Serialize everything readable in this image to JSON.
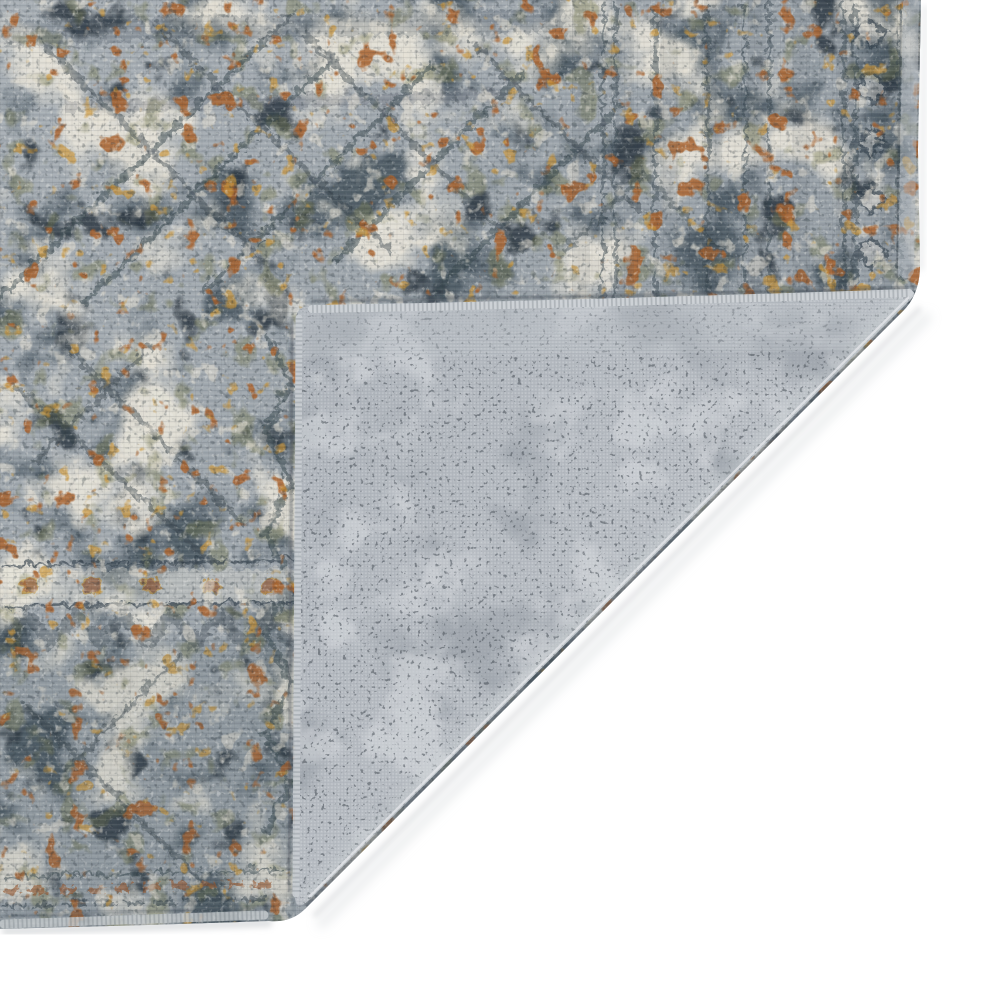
{
  "scene": {
    "type": "product-photo",
    "subject": "area-rug corner folded back to reveal woven backing",
    "rug_style": "distressed vintage oriental pattern in slate blue, gray, ivory with rust and gold accents",
    "backing_style": "fine gray machine-woven grid backing",
    "background": "plain white seamless backdrop",
    "visible_text": ""
  },
  "palette": {
    "white": "#ffffff",
    "pile_light": "#a9b0b6",
    "pile_base": "#8d969e",
    "cream": "#e9e5da",
    "cream2": "#e7e2d6",
    "dark_slate": "#46545f",
    "deep_ink": "#2c363f",
    "rust": "#a9622d",
    "gold": "#c9953a",
    "olive": "#72744c",
    "motif_dark": "#36434d",
    "rosette_fill": "#96542c",
    "rosette_ring": "#c9953a",
    "rust_band": "#a0592a",
    "grain_dark": "#273139",
    "grain_light": "#f2f2ef",
    "weave_base": "#b6bbc1",
    "weave_line": "#9aa0a8",
    "weave_dot": "#dde0e3",
    "backing_mid": "#aeb4bb",
    "backing_light_grad": "#cbcfd4",
    "backing_mottle_dark": "#949ba3",
    "backing_mottle_light": "#d7dade",
    "backing_speck": "#3e454d",
    "backing_ridge": "#c4c9ce",
    "serge_light": "#cfd3d7",
    "serge_left": "#c9cdd1",
    "bottom_serge": "#c6cacd",
    "right_binding": "#b6bcc2",
    "crease_highlight_col": "#e3e5e8",
    "crease_soft_col": "#ced3d8",
    "shadow_soft": "#cdd0d3",
    "shadow_tint": "#c7cacd",
    "junction_shadow": "#39424b",
    "crease_dark": "#4a525a"
  },
  "geometry": {
    "viewbox": "0 0 1000 1000",
    "rug_outline": "M0,0 L921,0 L918,150 L920,268 Q919,296 902,312 L305,909 Q291,923 269,921 L148,925 L0,929 Z",
    "flap_outline": "M912,291 Q917,293 911,299 L310,899 Q296,913 295,897 L296,320 Q296,307 309,306 Q480,303 700,297 Q820,294 912,291 Z",
    "backing_ridge_zone": "M297,304 L911,291 L905,350 L299,358 Z",
    "crease_edge_dark": "M905,309 L306,906",
    "crease_highlight": "M909,297 L309,897",
    "crease_soft_light": "M906,300 L307,900",
    "shadow_crease_outer": "M919,309 L315,915",
    "shadow_crease_outer2": "M926,318 L322,923",
    "shadow_bottom": "M6,931 L268,923",
    "shadow_right": "M925,8 L921,268",
    "flap_top_serge": "M312,309 Q560,305 909,293",
    "flap_left_serge": "M299,318 L296,894",
    "junction_top": "M312,301 Q560,298 908,288",
    "junction_left": "M292,318 L289,892",
    "pile_right_binding": "M911,4 L906,270",
    "pile_right_binding_inner": "M901,4 L897,268",
    "pile_bottom_serge": "M4,924 L264,915",
    "pile_bottom_inner": "M4,916 L266,908"
  }
}
